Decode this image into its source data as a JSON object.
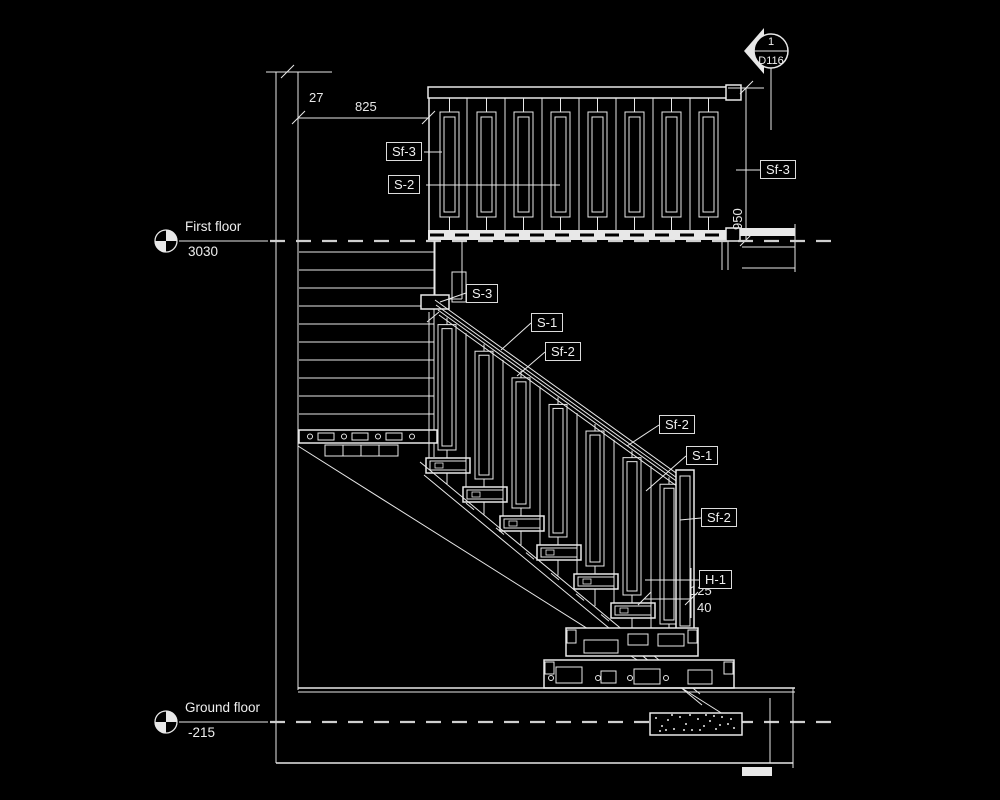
{
  "levels": {
    "first_floor": {
      "name": "First floor",
      "elevation": "3030"
    },
    "ground_floor": {
      "name": "Ground floor",
      "elevation": "-215"
    }
  },
  "section_callout": {
    "number": "1",
    "sheet": "D116"
  },
  "dimensions": {
    "wall_offset": "27",
    "landing_width": "825",
    "railing_height": "950",
    "post_offset": "125",
    "post_gap": "40"
  },
  "labels": {
    "sf3_left": "Sf-3",
    "s2_left": "S-2",
    "sf3_right": "Sf-3",
    "s3": "S-3",
    "s1_flight": "S-1",
    "sf2_flight": "Sf-2",
    "sf2_right_upper": "Sf-2",
    "s1_right": "S-1",
    "sf2_right_lower": "Sf-2",
    "h1": "H-1"
  }
}
